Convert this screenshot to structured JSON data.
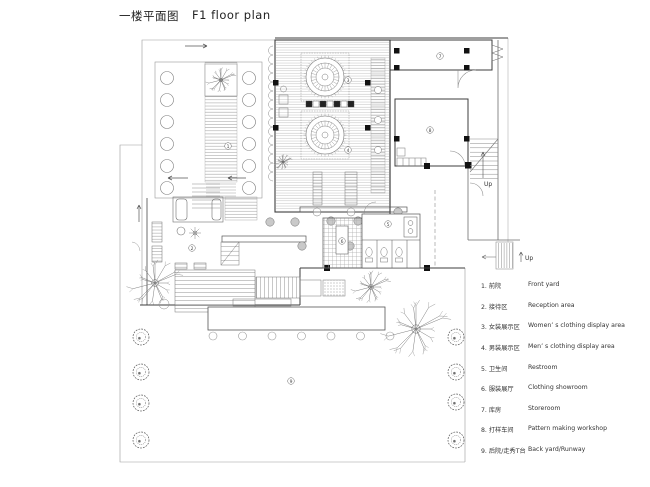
{
  "title": {
    "zh": "一楼平面图",
    "en": "F1 floor plan"
  },
  "plan": {
    "up_labels": {
      "interior": "Up",
      "exterior": "Up"
    },
    "area_markers": [
      "1",
      "2",
      "3",
      "4",
      "5",
      "6",
      "7",
      "8",
      "9"
    ]
  },
  "legend": {
    "items": [
      {
        "zh": "1. 前院",
        "en": "Front yard"
      },
      {
        "zh": "2. 接待区",
        "en": "Reception area"
      },
      {
        "zh": "3. 女装展示区",
        "en": "Women’ s clothing display area"
      },
      {
        "zh": "4. 男装展示区",
        "en": "Men’ s clothing display area"
      },
      {
        "zh": "5. 卫生间",
        "en": "Restroom"
      },
      {
        "zh": "6. 服装展厅",
        "en": "Clothing showroom"
      },
      {
        "zh": "7. 库房",
        "en": "Storeroom"
      },
      {
        "zh": "8. 打样车间",
        "en": "Pattern making workshop"
      },
      {
        "zh": "9. 后院/走秀T台",
        "en": "Back yard/Runway"
      }
    ]
  },
  "colors": {
    "line": "#8a8a8a",
    "wall": "#3c3c3c",
    "accent_black": "#111111",
    "text": "#333333"
  }
}
